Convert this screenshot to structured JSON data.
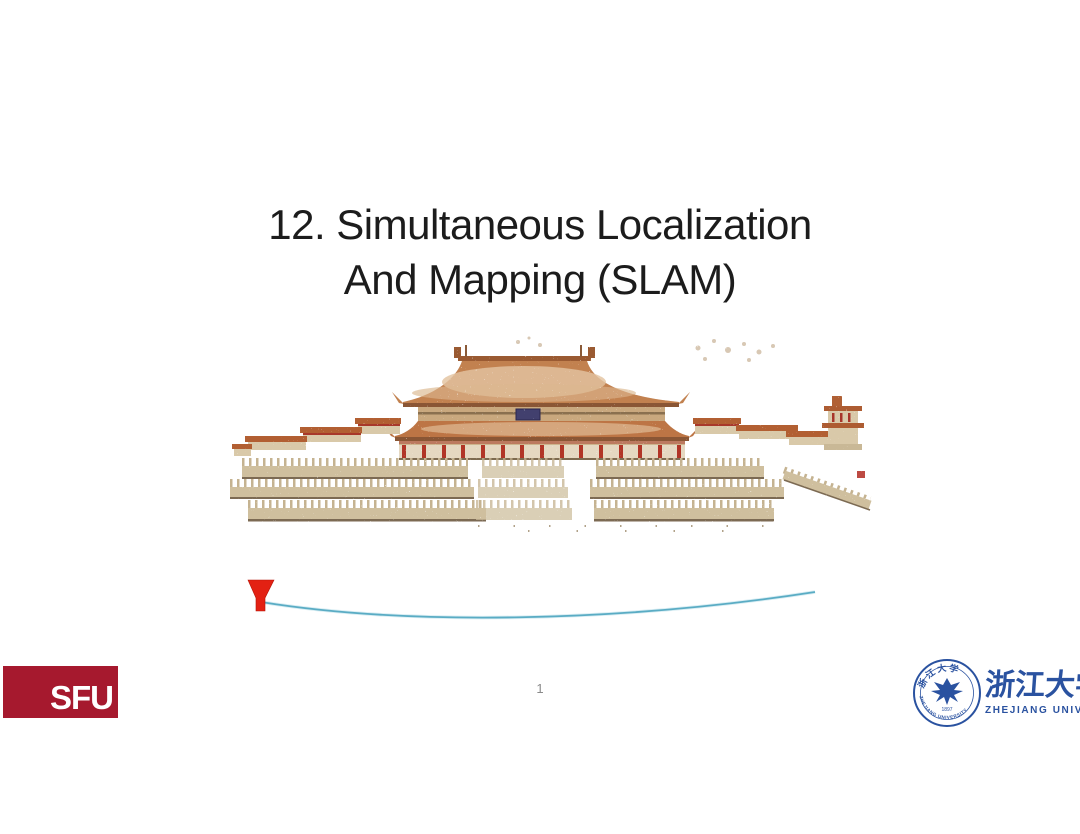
{
  "slide": {
    "title": {
      "line1": "12. Simultaneous Localization",
      "line2": "And Mapping (SLAM)"
    }
  },
  "figure": {
    "subject": "palace-point-cloud-render",
    "trajectory_color": "#5aacc4",
    "camera_marker_color": "#e32113",
    "roof_color": "#c28150",
    "terrace_color": "#cfbf9e",
    "column_color": "#b13427"
  },
  "footer": {
    "page_number": "1",
    "sfu_logo": {
      "text": "SFU",
      "bg_color": "#a6192e",
      "text_color": "#ffffff"
    },
    "zju_logo": {
      "chinese_name": "浙江大学",
      "english_name": "ZHEJIANG UNIVERSITY",
      "seal_year": "1897",
      "seal_ring_text": "ZHEJIANG UNIVERSITY",
      "color": "#2a52a0"
    }
  }
}
